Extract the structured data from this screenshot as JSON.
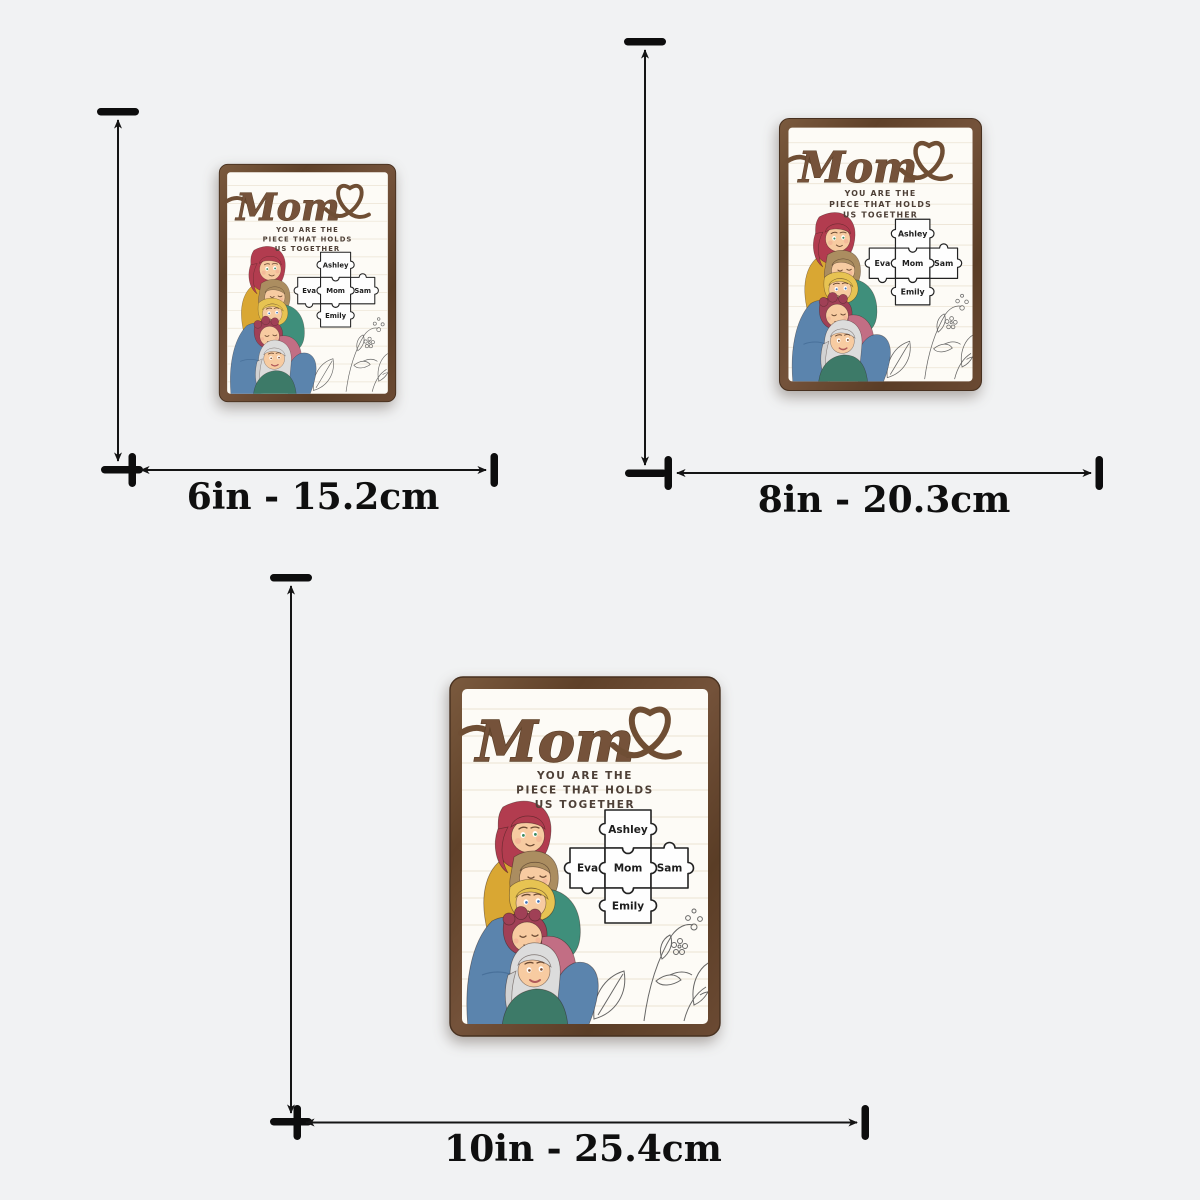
{
  "page": {
    "background": "#f1f2f3"
  },
  "sizes": [
    {
      "inches": "6in",
      "label": "6in - 15.2cm"
    },
    {
      "inches": "8in",
      "label": "8in - 20.3cm"
    },
    {
      "inches": "10in",
      "label": "10in - 25.4cm"
    }
  ],
  "plaque": {
    "title": "Mom",
    "message": [
      "YOU ARE THE",
      "PIECE THAT HOLDS",
      "US TOGETHER"
    ],
    "puzzle": {
      "top": "Ashley",
      "left": "Eva",
      "center": "Mom",
      "right": "Sam",
      "bottom": "Emily"
    },
    "icons": {
      "heart": "heart-outline-icon",
      "dimension": "double-headed-arrow"
    },
    "colors": {
      "frame_wood": "#6a4a33",
      "script_brown": "#6f4e34",
      "message_text": "#4e4037",
      "panel_paper": "#fdfbf6",
      "puzzle_fill": "#fefefe",
      "puzzle_outline": "#222222",
      "arrow_black": "#141414",
      "hair_red": "#b23c4f",
      "sweater_mustard": "#d9a733",
      "top_teal": "#3f8f7b",
      "hair_blonde": "#e7c352",
      "hair_plum": "#a04056",
      "top_pink": "#c26e84",
      "hair_silver": "#dcdcdc",
      "sweater_green": "#3d7a68",
      "jeans_blue": "#5b84ad"
    }
  }
}
